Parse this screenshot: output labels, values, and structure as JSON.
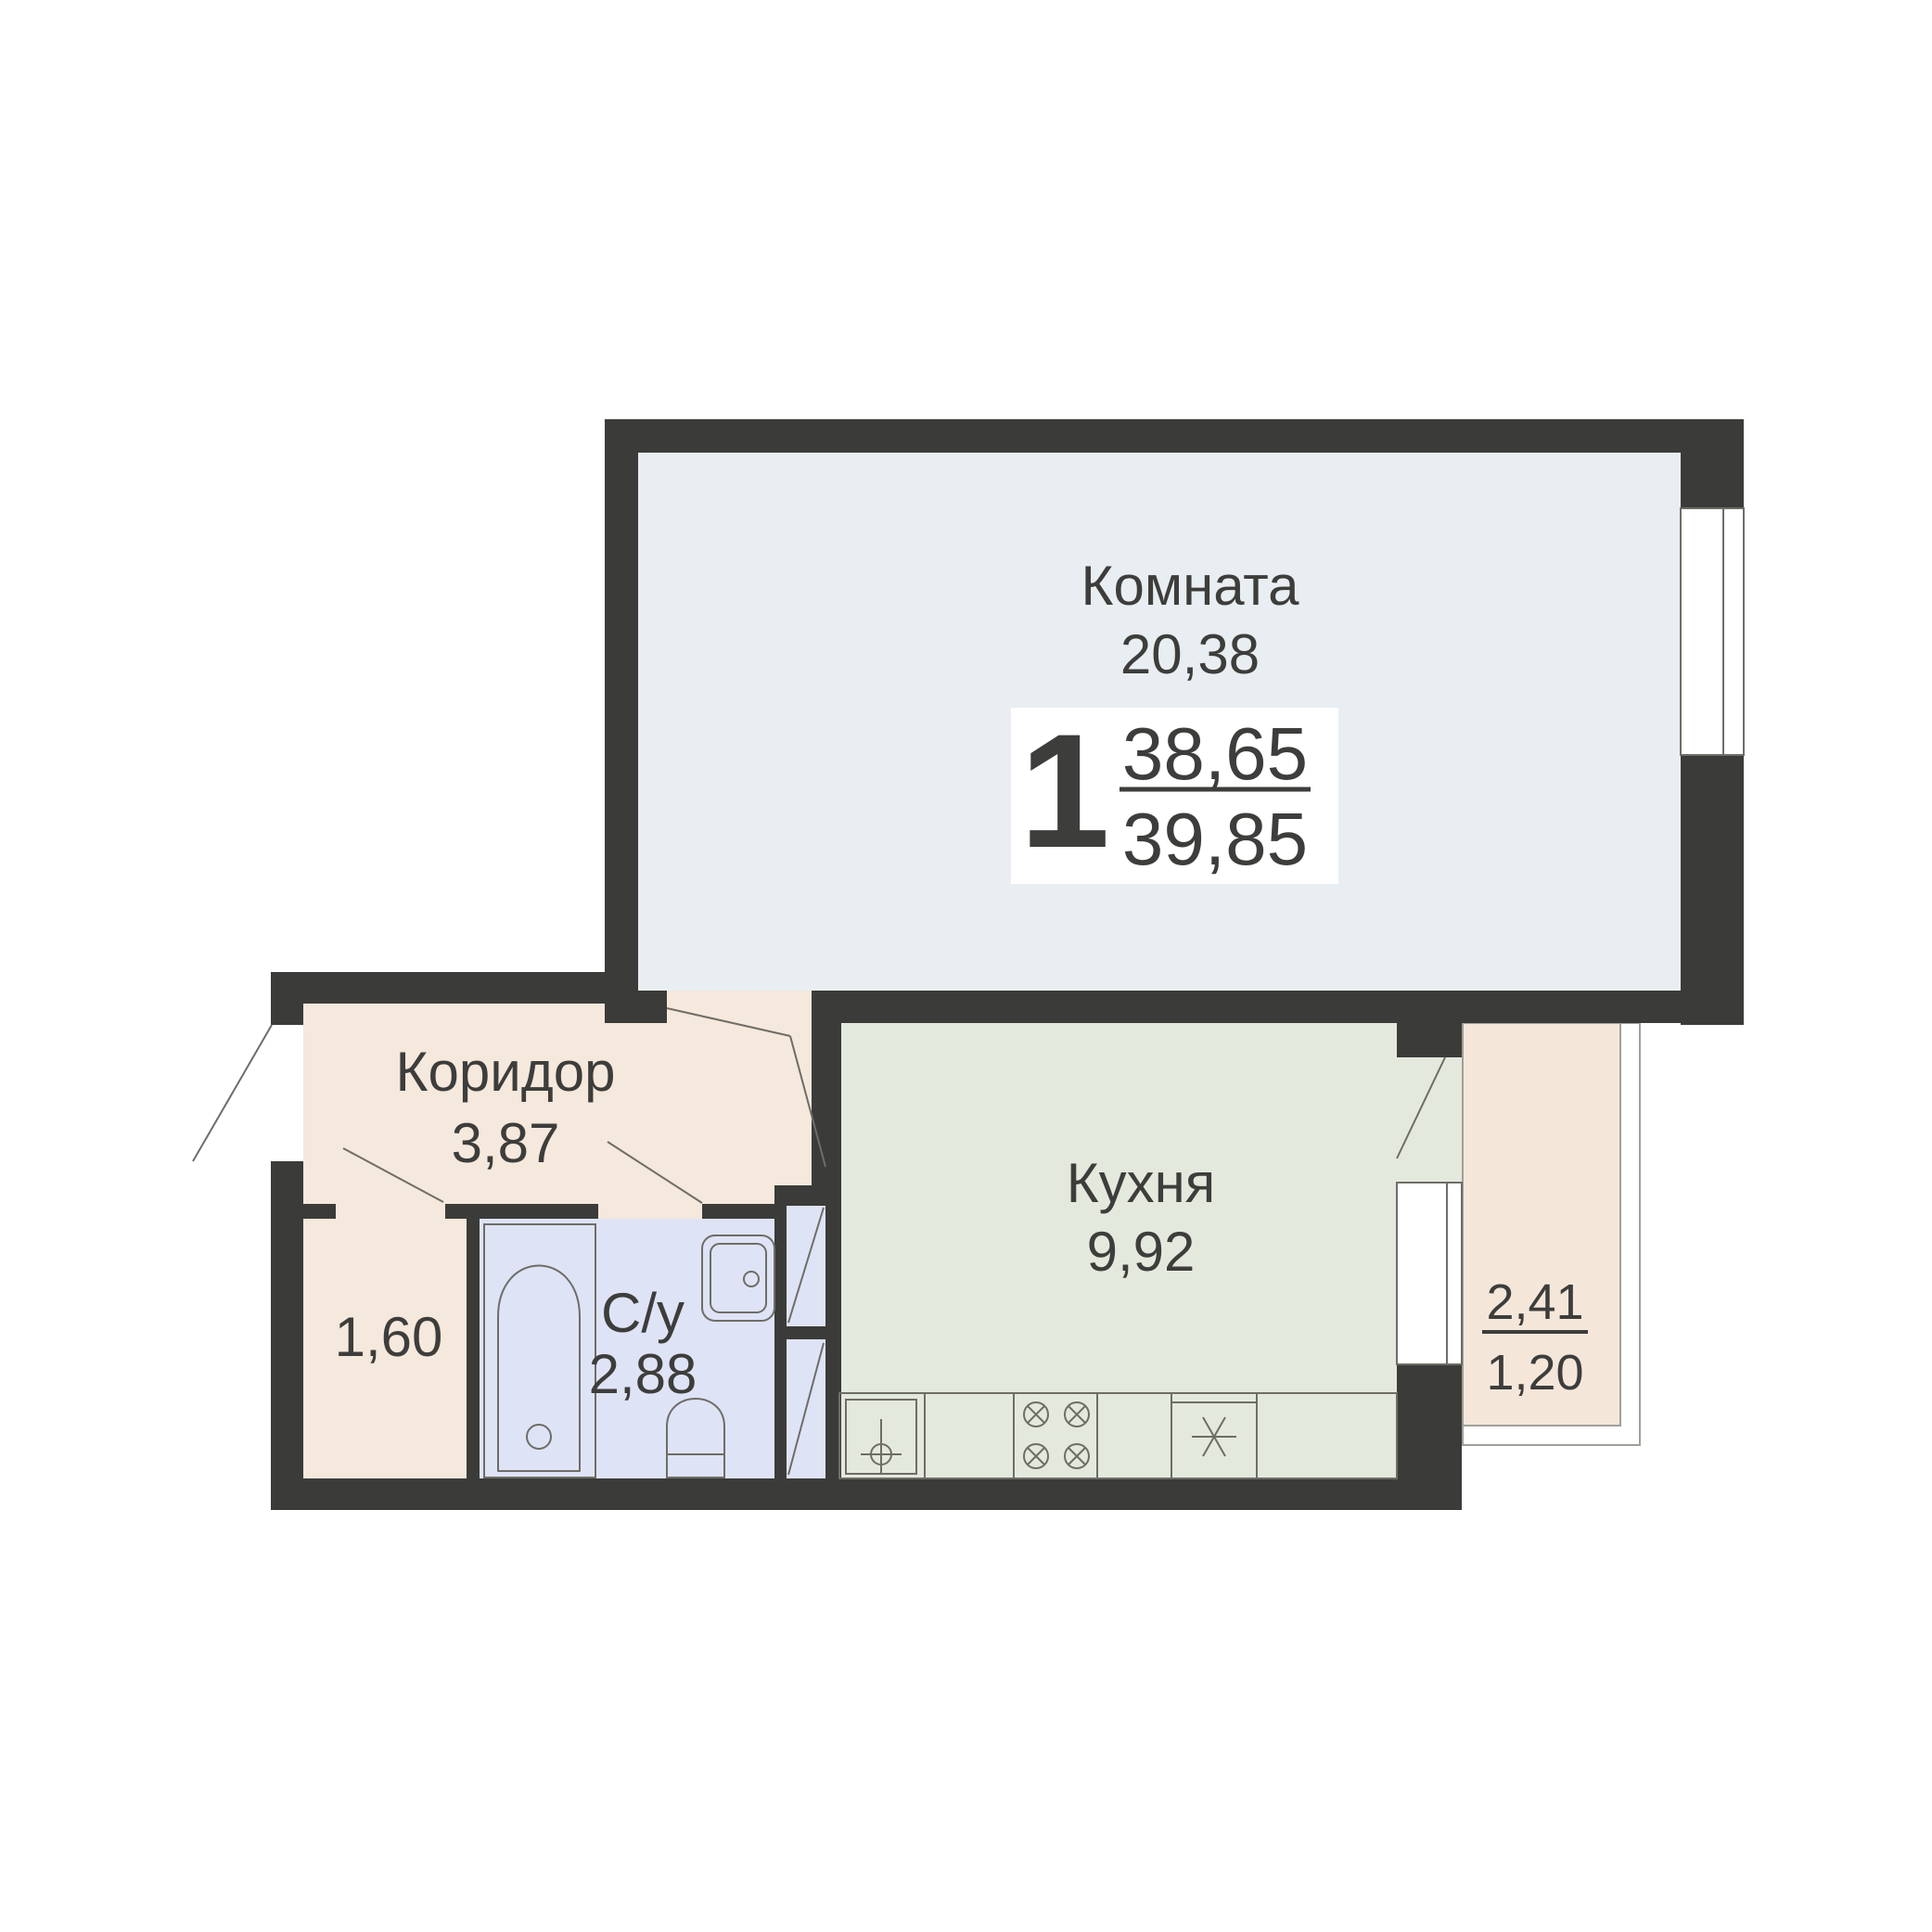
{
  "colors": {
    "wall": "#3b3b39",
    "line": "#6e6d66",
    "rail": "#a09f98",
    "text": "#3d3d3b",
    "room": "#e8eef1",
    "corridor": "#f5e8dc",
    "kitchen": "#e4e9dd",
    "bathroom": "#dfe3f6",
    "balcony": "#f4e7da",
    "window": "#ffffff",
    "badge_bg": "#ffffff"
  },
  "rooms": {
    "living": {
      "name": "Комната",
      "area": "20,38"
    },
    "corridor": {
      "name": "Коридор",
      "area": "3,87"
    },
    "kitchen": {
      "name": "Кухня",
      "area": "9,92"
    },
    "bathroom": {
      "name": "С/у",
      "area": "2,88"
    },
    "storage": {
      "area": "1,60"
    },
    "balcony": {
      "area_full": "2,41",
      "area_reduced": "1,20"
    }
  },
  "badge": {
    "rooms_count": "1",
    "area_living": "38,65",
    "area_total": "39,85"
  }
}
